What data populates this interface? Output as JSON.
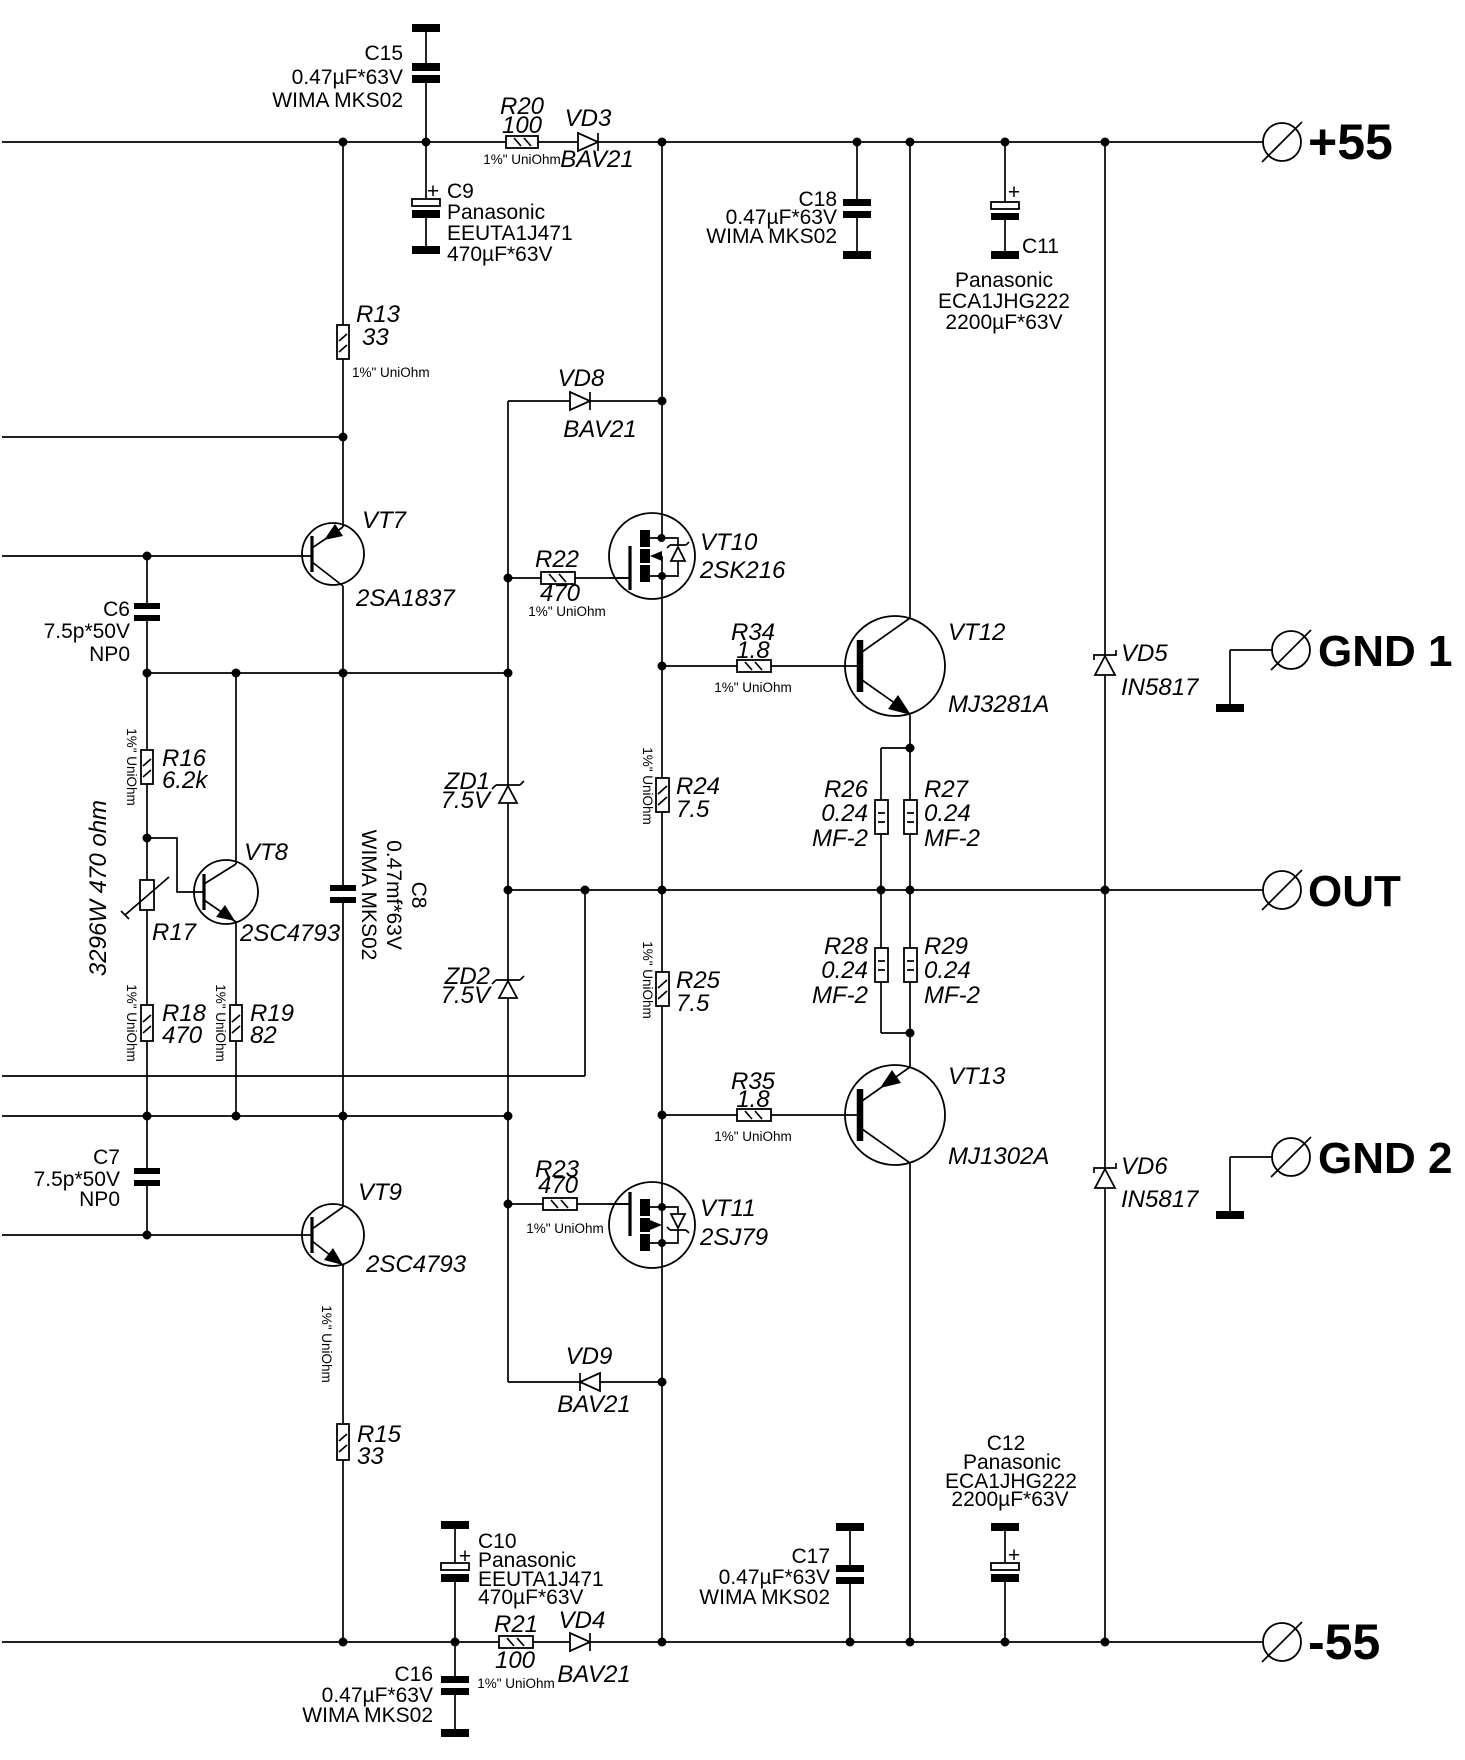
{
  "terminals": {
    "p55": {
      "label": "+55"
    },
    "gnd1": {
      "label": "GND 1"
    },
    "out": {
      "label": "OUT"
    },
    "gnd2": {
      "label": "GND 2"
    },
    "m55": {
      "label": "-55"
    }
  },
  "components": {
    "C15": {
      "ref": "C15",
      "value": "0.47µF*63V",
      "part": "WIMA MKS02"
    },
    "C9": {
      "plus": "+",
      "ref": "C9",
      "brand": "Panasonic",
      "part": "EEUTA1J471",
      "value": "470µF*63V"
    },
    "C18": {
      "ref": "C18",
      "value": "0.47µF*63V",
      "part": "WIMA MKS02"
    },
    "C11": {
      "plus": "+",
      "ref": "C11",
      "brand": "Panasonic",
      "part": "ECA1JHG222",
      "value": "2200µF*63V"
    },
    "C6": {
      "ref": "C6",
      "value": "7.5p*50V",
      "part": "NP0"
    },
    "C7": {
      "ref": "C7",
      "value": "7.5p*50V",
      "part": "NP0"
    },
    "C8": {
      "ref": "C8",
      "value": "0.47mf*63V",
      "part": "WIMA MKS02"
    },
    "C10": {
      "plus": "+",
      "ref": "C10",
      "brand": "Panasonic",
      "part": "EEUTA1J471",
      "value": "470µF*63V"
    },
    "C16": {
      "ref": "C16",
      "value": "0.47µF*63V",
      "part": "WIMA MKS02"
    },
    "C17": {
      "ref": "C17",
      "value": "0.47µF*63V",
      "part": "WIMA MKS02"
    },
    "C12": {
      "ref": "C12",
      "plus": "+",
      "brand": "Panasonic",
      "part": "ECA1JHG222",
      "value": "2200µF*63V"
    },
    "R13": {
      "ref": "R13",
      "value": "33",
      "tol": "1%\" UniOhm"
    },
    "R15": {
      "ref": "R15",
      "value": "33",
      "tol": "1%\" UniOhm"
    },
    "R16": {
      "ref": "R16",
      "value": "6.2k",
      "tol": "1%\" UniOhm"
    },
    "R17": {
      "ref": "R17",
      "part": "3296W 470 ohm"
    },
    "R18": {
      "ref": "R18",
      "value": "470",
      "tol": "1%\" UniOhm"
    },
    "R19": {
      "ref": "R19",
      "value": "82",
      "tol": "1%\" UniOhm"
    },
    "R20": {
      "ref": "R20",
      "value": "100",
      "tol": "1%\" UniOhm"
    },
    "R21": {
      "ref": "R21",
      "value": "100",
      "tol": "1%\" UniOhm"
    },
    "R22": {
      "ref": "R22",
      "value": "470",
      "tol": "1%\" UniOhm"
    },
    "R23": {
      "ref": "R23",
      "value": "470",
      "tol": "1%\" UniOhm"
    },
    "R24": {
      "ref": "R24",
      "value": "7.5",
      "tol": "1%\" UniOhm"
    },
    "R25": {
      "ref": "R25",
      "value": "7.5",
      "tol": "1%\" UniOhm"
    },
    "R26": {
      "ref": "R26",
      "value": "0.24",
      "part": "MF-2"
    },
    "R27": {
      "ref": "R27",
      "value": "0.24",
      "part": "MF-2"
    },
    "R28": {
      "ref": "R28",
      "value": "0.24",
      "part": "MF-2"
    },
    "R29": {
      "ref": "R29",
      "value": "0.24",
      "part": "MF-2"
    },
    "R34": {
      "ref": "R34",
      "value": "1.8",
      "tol": "1%\" UniOhm"
    },
    "R35": {
      "ref": "R35",
      "value": "1.8",
      "tol": "1%\" UniOhm"
    },
    "VD3": {
      "ref": "VD3",
      "part": "BAV21"
    },
    "VD4": {
      "ref": "VD4",
      "part": "BAV21"
    },
    "VD5": {
      "ref": "VD5",
      "part": "IN5817"
    },
    "VD6": {
      "ref": "VD6",
      "part": "IN5817"
    },
    "VD8": {
      "ref": "VD8",
      "part": "BAV21"
    },
    "VD9": {
      "ref": "VD9",
      "part": "BAV21"
    },
    "ZD1": {
      "ref": "ZD1",
      "value": "7.5V"
    },
    "ZD2": {
      "ref": "ZD2",
      "value": "7.5V"
    },
    "VT7": {
      "ref": "VT7",
      "part": "2SA1837"
    },
    "VT8": {
      "ref": "VT8",
      "part": "2SC4793"
    },
    "VT9": {
      "ref": "VT9",
      "part": "2SC4793"
    },
    "VT10": {
      "ref": "VT10",
      "part": "2SK216"
    },
    "VT11": {
      "ref": "VT11",
      "part": "2SJ79"
    },
    "VT12": {
      "ref": "VT12",
      "part": "MJ3281A"
    },
    "VT13": {
      "ref": "VT13",
      "part": "MJ1302A"
    }
  }
}
